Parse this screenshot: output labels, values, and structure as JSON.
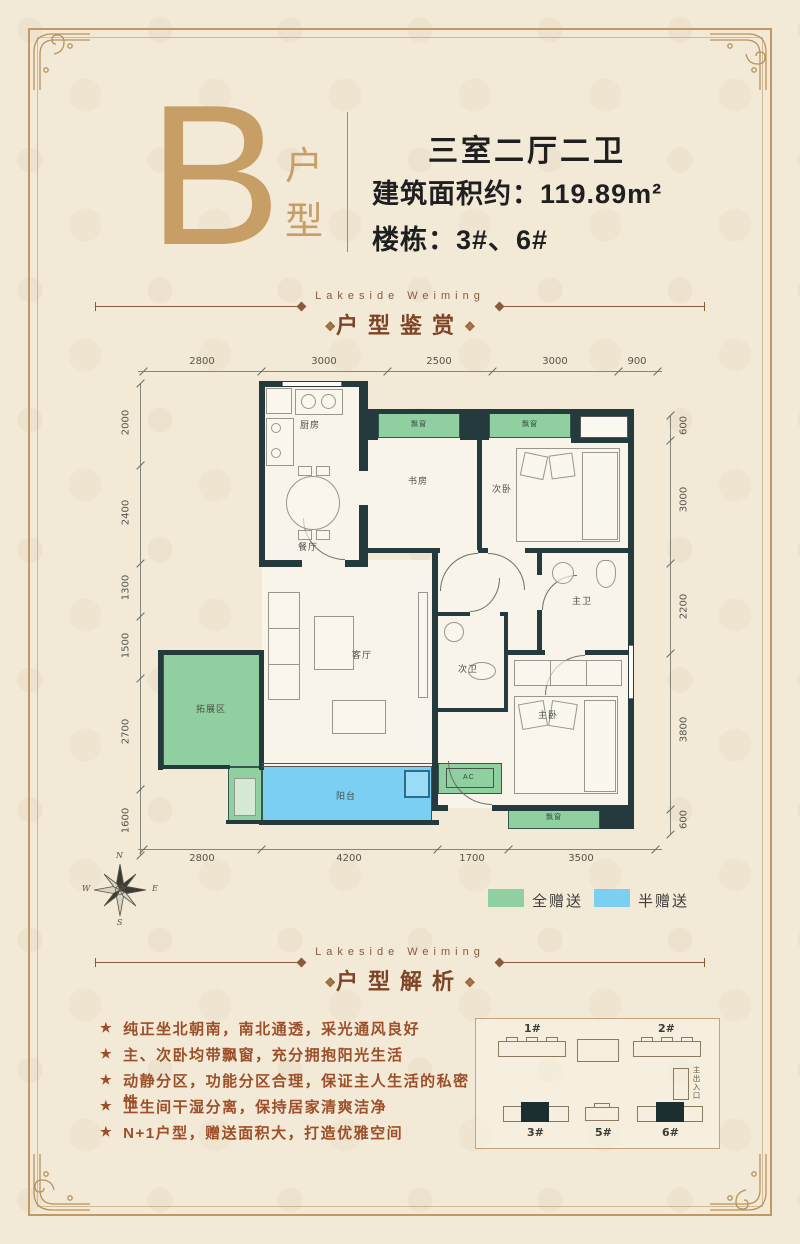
{
  "header": {
    "type_letter": "B",
    "type_word_1": "户",
    "type_word_2": "型",
    "layout": "三室二厅二卫",
    "area": "建筑面积约：119.89m²",
    "buildings": "楼栋：3#、6#"
  },
  "section_appreciation": {
    "en": "Lakeside Weiming",
    "zh": "户型鉴赏",
    "ornament": "❖"
  },
  "section_analysis": {
    "en": "Lakeside Weiming",
    "zh": "户型解析",
    "ornament": "❖"
  },
  "plan": {
    "rooms": {
      "kitchen": "厨房",
      "dining": "餐厅",
      "study": "书房",
      "bedroom2": "次卧",
      "living": "客厅",
      "bath_master": "主卫",
      "bath_second": "次卫",
      "master": "主卧",
      "bonus": "拓展区",
      "balcony": "阳台",
      "bay": "飘窗",
      "ac": "AC"
    },
    "dims": {
      "top": [
        "2800",
        "3000",
        "2500",
        "3000",
        "900"
      ],
      "bottom": [
        "2800",
        "4200",
        "1700",
        "3500"
      ],
      "left": [
        "2000",
        "2400",
        "1300",
        "1500",
        "2700",
        "1600"
      ],
      "right": [
        "600",
        "3000",
        "2200",
        "3800",
        "600"
      ]
    }
  },
  "legend": {
    "full_label": "全赠送",
    "full_color": "#8fcfa0",
    "half_label": "半赠送",
    "half_color": "#7bd0f1"
  },
  "compass": {
    "n": "N",
    "e": "E",
    "s": "S",
    "w": "W"
  },
  "analysis": {
    "star": "★",
    "items": [
      "纯正坐北朝南，南北通透，采光通风良好",
      "主、次卧均带飘窗，充分拥抱阳光生活",
      "动静分区，功能分区合理，保证主人生活的私密性",
      "卫生间干湿分离，保持居家清爽洁净",
      "N+1户型，赠送面积大，打造优雅空间"
    ]
  },
  "sitemap": {
    "b1": "1#",
    "b2": "2#",
    "b3": "3#",
    "b5": "5#",
    "b6": "6#",
    "entrance": "主出入口"
  },
  "colors": {
    "accent_gold": "#c49a62",
    "brown_text": "#8a4f2e",
    "wall": "#243a3d"
  }
}
